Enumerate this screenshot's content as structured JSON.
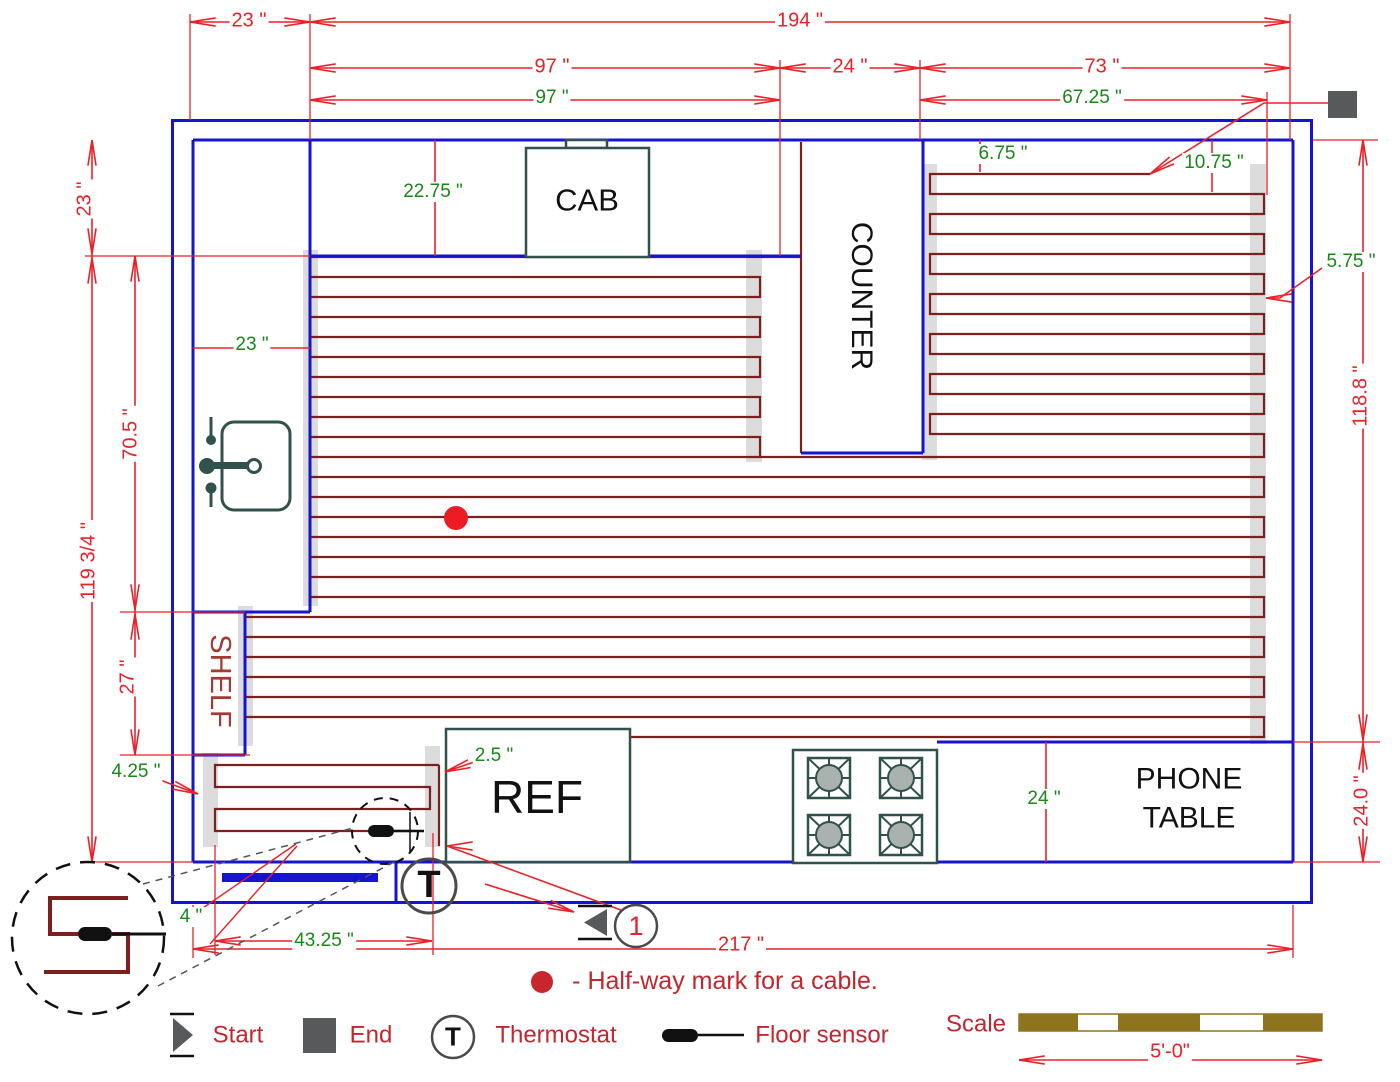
{
  "figure": "kitchen-floor-heating-plan",
  "colors": {
    "wall_blue": "#1414D2",
    "cable_maroon": "#7D1F1F",
    "dimension_red": "#EA2128",
    "dimension_green": "#188818",
    "legend_red": "#C2262E",
    "fixture_dark": "#31514D",
    "backing_gray": "#DCDCDC",
    "marker_gray": "#58595B",
    "scale_brown": "#8F7420",
    "halfway_dot_red": "#ED1B24"
  },
  "rooms": {
    "cab": "CAB",
    "counter": "COUNTER",
    "shelf": "SHELF",
    "ref": "REF",
    "phone_line1": "PHONE",
    "phone_line2": "TABLE"
  },
  "dimensions": {
    "d23_top": "23 \"",
    "d194": "194 \"",
    "d97_red": "97 \"",
    "d24_top": "24 \"",
    "d73": "73 \"",
    "d97_green": "97 \"",
    "d67_25": "67.25 \"",
    "d22_75": "22.75 \"",
    "d6_75": "6.75 \"",
    "d10_75": "10.75 \"",
    "d5_75": "5.75 \"",
    "d23_left": "23 \"",
    "d119_34": "119 3/4 \"",
    "d70_5": "70.5 \"",
    "d27": "27 \"",
    "d23_sink": "23 \"",
    "d118_8": "118.8 \"",
    "d24_0": "24.0 \"",
    "d24_phone": "24 \"",
    "d4_25": "4.25 \"",
    "d2_5": "2.5 \"",
    "d4": "4 \"",
    "d43_25": "43.25 \"",
    "d217": "217 \""
  },
  "markers": {
    "start_number": "1",
    "thermostat_letter": "T",
    "thermostat_letter_legend": "T"
  },
  "legend": {
    "start": "Start",
    "end": "End",
    "thermostat": "Thermostat",
    "floor_sensor": "Floor sensor",
    "halfway_note": "- Half-way mark for a cable.",
    "scale_label": "Scale",
    "scale_length": "5'-0\""
  }
}
